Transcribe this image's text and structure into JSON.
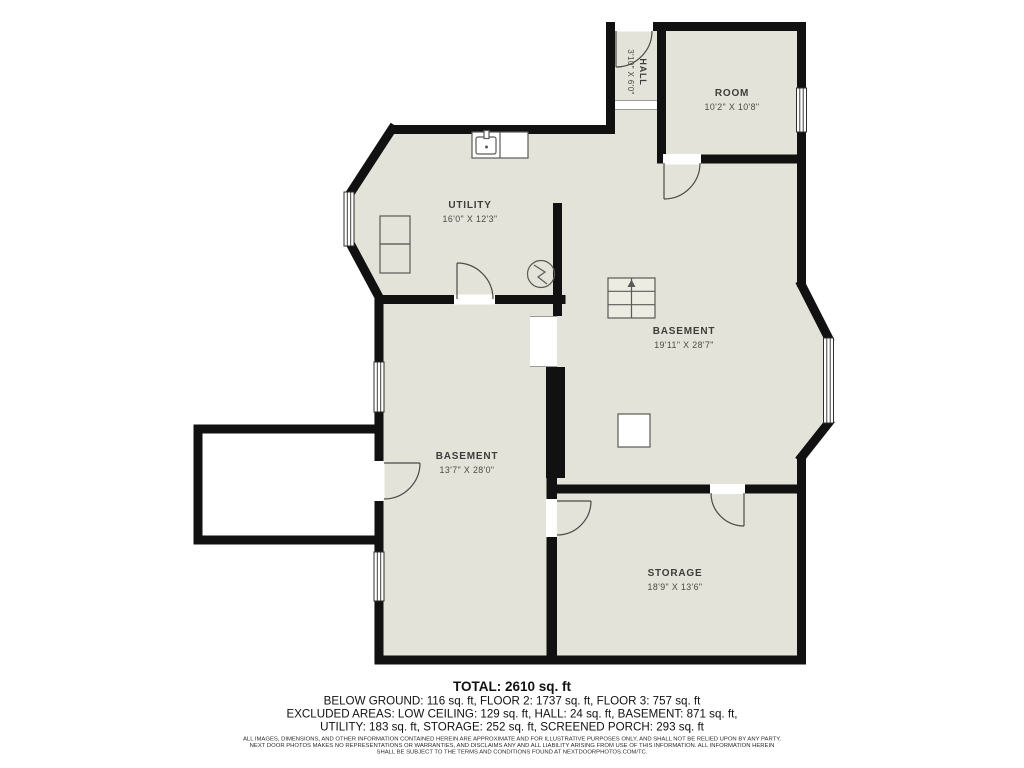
{
  "colors": {
    "background": "#ffffff",
    "floor": "#e4e3d9",
    "wall": "#111111",
    "label": "#3d3d3b"
  },
  "rooms": [
    {
      "name": "HALL",
      "dims": "3'10\" X 6'0\""
    },
    {
      "name": "ROOM",
      "dims": "10'2\" X 10'8\""
    },
    {
      "name": "UTILITY",
      "dims": "16'0\" X 12'3\""
    },
    {
      "name": "BASEMENT",
      "dims": "19'11\" X 28'7\""
    },
    {
      "name": "BASEMENT",
      "dims": "13'7\" X 28'0\""
    },
    {
      "name": "STORAGE",
      "dims": "18'9\" X 13'6\""
    }
  ],
  "symbols": [
    {
      "name": "stairs-icon"
    },
    {
      "name": "water-heater-icon"
    },
    {
      "name": "sink-icon"
    },
    {
      "name": "appliance-icon"
    },
    {
      "name": "support-post-icon"
    }
  ],
  "summary": {
    "total": "TOTAL: 2610 sq. ft",
    "line1": "BELOW GROUND: 116 sq. ft, FLOOR 2: 1737 sq. ft, FLOOR 3: 757 sq. ft",
    "line2": "EXCLUDED AREAS: LOW CEILING: 129 sq. ft, HALL: 24 sq. ft, BASEMENT: 871 sq. ft,",
    "line3": "UTILITY: 183 sq. ft, STORAGE: 252 sq. ft, SCREENED PORCH: 293 sq. ft"
  },
  "disclaimer": {
    "line1": "ALL IMAGES, DIMENSIONS, AND OTHER INFORMATION CONTAINED HEREIN ARE APPROXIMATE AND FOR ILLUSTRATIVE PURPOSES ONLY, AND SHALL NOT BE RELIED UPON BY ANY PARTY.",
    "line2": "NEXT DOOR PHOTOS MAKES NO REPRESENTATIONS OR WARRANTIES, AND DISCLAIMS ANY AND ALL LIABILITY ARISING FROM USE OF THIS INFORMATION. ALL INFORMATION HEREIN",
    "line3": "SHALL BE SUBJECT TO THE TERMS AND CONDITIONS FOUND AT NEXTDOORPHOTOS.COM/TC."
  }
}
